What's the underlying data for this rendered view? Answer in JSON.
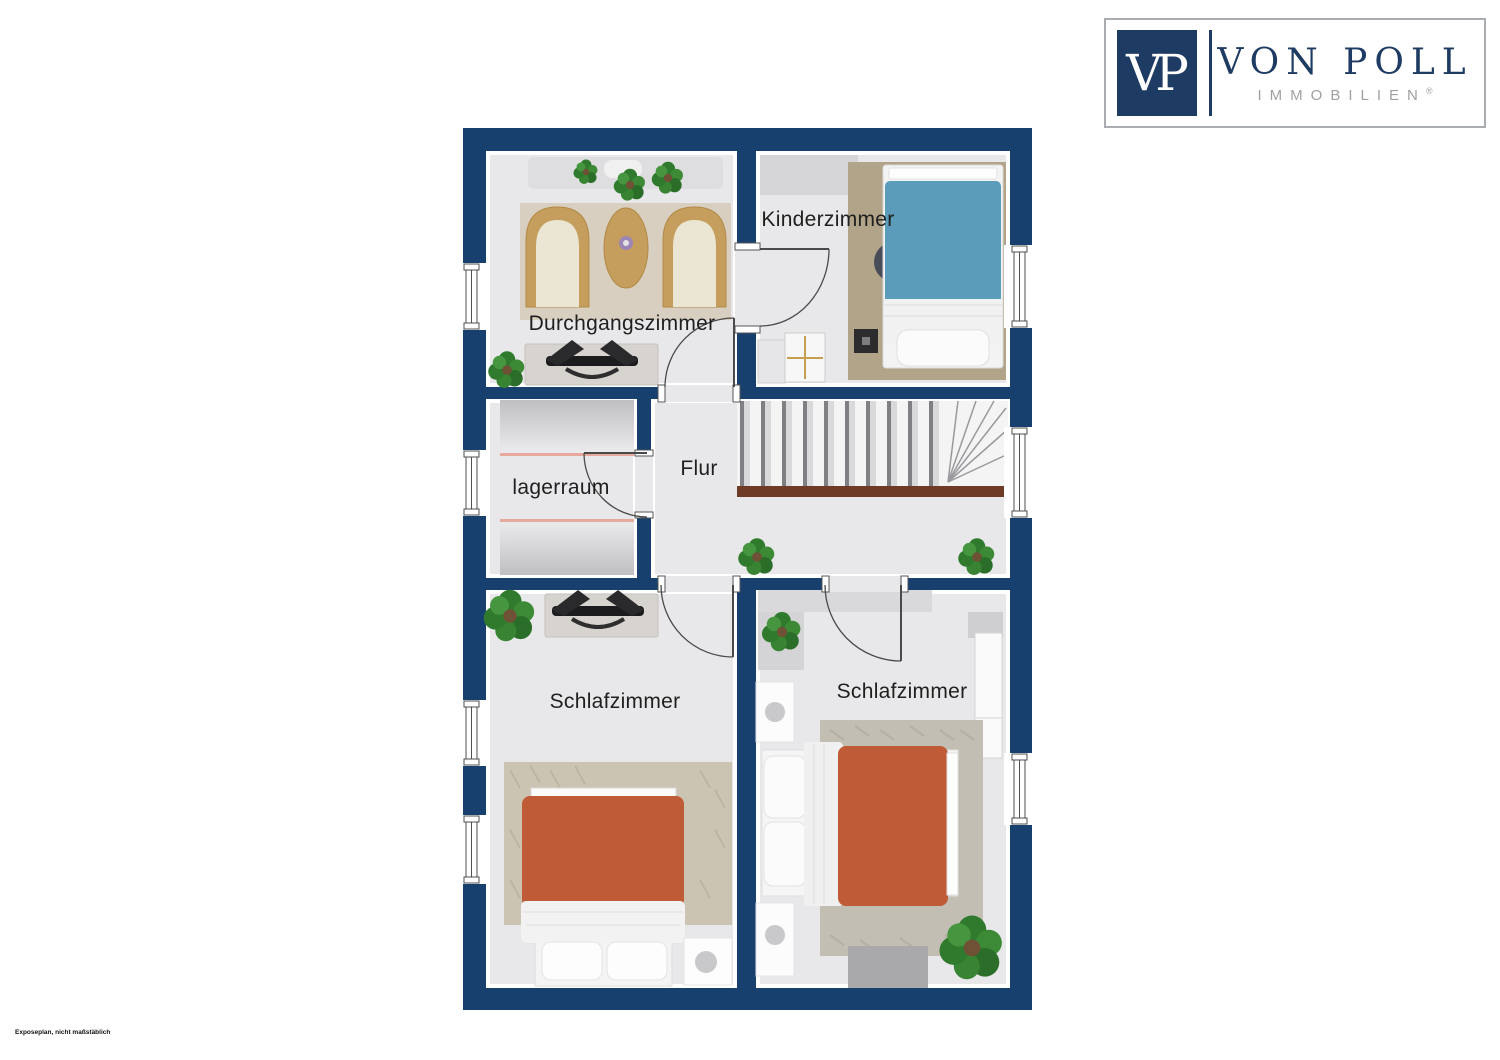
{
  "logo": {
    "monogram": "VP",
    "brand": "VON POLL",
    "subbrand": "IMMOBILIEN",
    "registered": "®",
    "navy": "#1e3b63",
    "gray": "#9ea1a4"
  },
  "disclaimer": "Exposeplan, nicht maßstäblich",
  "floorplan": {
    "rooms": [
      {
        "id": "durchgangszimmer",
        "label": "Durchgangszimmer"
      },
      {
        "id": "kinderzimmer",
        "label": "Kinderzimmer"
      },
      {
        "id": "lagerraum",
        "label": "lagerraum"
      },
      {
        "id": "flur",
        "label": "Flur"
      },
      {
        "id": "schlafzimmer_links",
        "label": "Schlafzimmer"
      },
      {
        "id": "schlafzimmer_rechts",
        "label": "Schlafzimmer"
      }
    ],
    "colors": {
      "wall": "#17406e",
      "floor": "#e8e8ea",
      "stair_rail": "#6e3b26",
      "bed_terracotta": "#c05b38",
      "bed_blue": "#5b9cba",
      "rug_tan": "#b2a489",
      "rug_beige": "#cbc4b3",
      "rug_gray": "#c2beb4"
    }
  }
}
